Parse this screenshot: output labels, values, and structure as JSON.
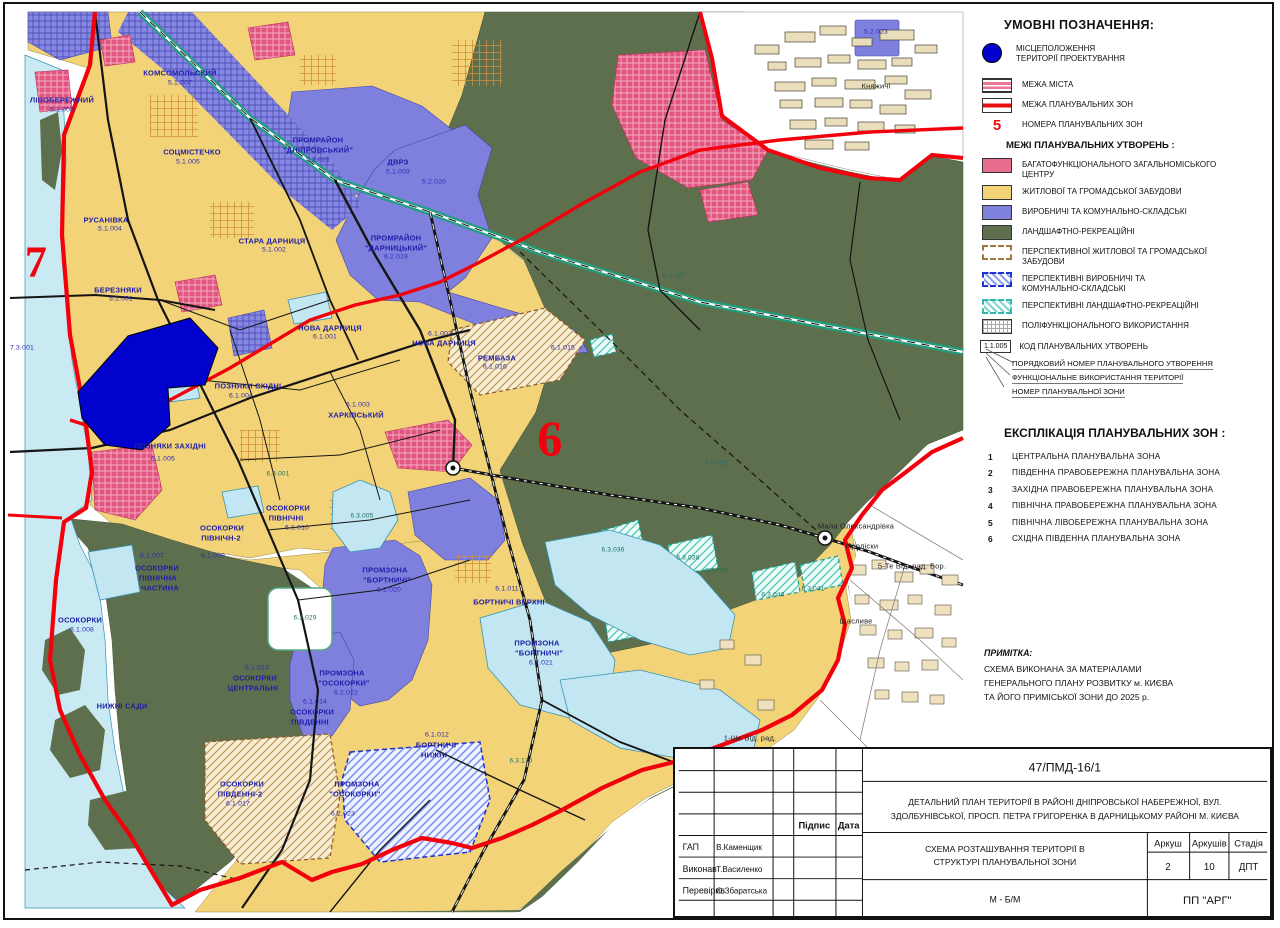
{
  "legend": {
    "title": "УМОВНІ ПОЗНАЧЕННЯ:",
    "location": {
      "lines": [
        "МІСЦЕПОЛОЖЕННЯ",
        "ТЕРИТОРІЇ ПРОЕКТУВАННЯ"
      ]
    },
    "boundary_items": [
      {
        "swatch": "city",
        "label": "МЕЖА МІСТА"
      },
      {
        "swatch": "zone",
        "label": "МЕЖА ПЛАНУВАЛЬНИХ ЗОН"
      },
      {
        "swatch": "number",
        "symbol": "5",
        "label": "НОМЕРА ПЛАНУВАЛЬНИХ ЗОН"
      }
    ]
  },
  "formations": {
    "title": "МЕЖІ ПЛАНУВАЛЬНИХ УТВОРЕНЬ :",
    "items": [
      {
        "swatch": "pink",
        "lines": [
          "БАГАТОФУНКЦІОНАЛЬНОГО ЗАГАЛЬНОМІСЬКОГО",
          "ЦЕНТРУ"
        ]
      },
      {
        "swatch": "yellow",
        "lines": [
          "ЖИТЛОВОЇ ТА ГРОМАДСЬКОЇ ЗАБУДОВИ"
        ]
      },
      {
        "swatch": "purple",
        "lines": [
          "ВИРОБНИЧІ ТА КОМУНАЛЬНО-СКЛАДСЬКІ"
        ]
      },
      {
        "swatch": "green",
        "lines": [
          "ЛАНДШАФТНО-РЕКРЕАЦІЙНІ"
        ]
      },
      {
        "swatch": "dash-tan",
        "lines": [
          "ПЕРСПЕКТИВНОЇ ЖИТЛОВОЇ ТА ГРОМАДСЬКОЇ",
          "ЗАБУДОВИ"
        ]
      },
      {
        "swatch": "dash-blue",
        "lines": [
          "ПЕРСПЕКТИВНІ ВИРОБНИЧІ ТА",
          "КОМУНАЛЬНО-СКЛАДСЬКІ"
        ]
      },
      {
        "swatch": "dash-teal",
        "lines": [
          "ПЕРСПЕКТИВНІ ЛАНДШАФТНО-РЕКРЕАЦІЙНІ"
        ]
      },
      {
        "swatch": "grid",
        "lines": [
          "ПОЛІФУНКЦІОНАЛЬНОГО ВИКОРИСТАННЯ"
        ]
      }
    ],
    "code_example": "1.1.005",
    "code_label": "КОД ПЛАНУВАЛЬНИХ УТВОРЕНЬ",
    "code_callouts": [
      "ПОРЯДКОВИЙ НОМЕР ПЛАНУВАЛЬНОГО УТВОРЕННЯ",
      "ФУНКЦІОНАЛЬНЕ ВИКОРИСТАННЯ ТЕРИТОРІЇ",
      "НОМЕР ПЛАНУВАЛЬНОЇ ЗОНИ"
    ]
  },
  "explication": {
    "title": "ЕКСПЛІКАЦІЯ ПЛАНУВАЛЬНИХ ЗОН :",
    "zones": [
      {
        "num": "1",
        "label": "ЦЕНТРАЛЬНА ПЛАНУВАЛЬНА ЗОНА"
      },
      {
        "num": "2",
        "label": "ПІВДЕННА ПРАВОБЕРЕЖНА  ПЛАНУВАЛЬНА ЗОНА"
      },
      {
        "num": "3",
        "label": "ЗАХІДНА ПРАВОБЕРЕЖНА ПЛАНУВАЛЬНА  ЗОНА"
      },
      {
        "num": "4",
        "label": "ПІВНІЧНА ПРАВОБЕРЕЖНА ПЛАНУВАЛЬНА  ЗОНА"
      },
      {
        "num": "5",
        "label": "ПІВНІЧНА ЛІВОБЕРЕЖНА  ПЛАНУВАЛЬНА ЗОНА"
      },
      {
        "num": "6",
        "label": "СХІДНА ПІВДЕННА ПЛАНУВАЛЬНА ЗОНА"
      }
    ]
  },
  "note": {
    "title": "ПРИМІТКА:",
    "lines": [
      "СХЕМА ВИКОНАНА ЗА МАТЕРІАЛАМИ",
      "ГЕНЕРАЛЬНОГО ПЛАНУ РОЗВИТКУ м. КИЄВА",
      "ТА ЙОГО ПРИМІСЬКОЇ ЗОНИ ДО 2025 р."
    ]
  },
  "stamp": {
    "doc_number": "47/ПМД-16/1",
    "project_title_l1": "ДЕТАЛЬНИЙ  ПЛАН  ТЕРИТОРІЇ  В  РАЙОНІ  ДНІПРОВСЬКОЇ  НАБЕРЕЖНОЇ,  ВУЛ.",
    "project_title_l2": "ЗДОЛБУНІВСЬКОЇ, ПРОСП. ПЕТРА ГРИГОРЕНКА В ДАРНИЦЬКОМУ РАЙОНІ М. КИЄВА",
    "sheet_title_l1": "СХЕМА РОЗТАШУВАННЯ ТЕРИТОРІЇ В",
    "sheet_title_l2": "СТРУКТУРІ ПЛАНУВАЛЬНОЇ ЗОНИ",
    "col_signature": "Підпис",
    "col_date": "Дата",
    "people": [
      {
        "role": "ГАП",
        "name": "В.Каменщик"
      },
      {
        "role": "Виконав",
        "name": "Т.Василенко"
      },
      {
        "role": "Перевірив",
        "name": "О.Збаратська"
      }
    ],
    "sheet_label": "Аркуш",
    "sheets_label": "Аркушів",
    "stage_label": "Стадія",
    "sheet_value": "2",
    "sheets_value": "10",
    "stage_value": "ДПТ",
    "scale": "М - Б/М",
    "company": "ПП \"АРГ\""
  },
  "map": {
    "palette": {
      "residential": "#F2D377",
      "industrial": "#7F80DD",
      "landscape": "#5E6F4D",
      "city_center": "#E2557E",
      "water": "#C9E9F3",
      "project_site": "#0202CF",
      "boundary_red": "#F2000C"
    },
    "labels": [
      {
        "t": "ЛІВОБЕРЕЖНИЙ",
        "x": 62,
        "y": 100,
        "c": "d"
      },
      {
        "t": "5.1.008",
        "x": 62,
        "y": 110,
        "c": "c"
      },
      {
        "t": "КОМСОМОЛЬСКИЙ",
        "x": 180,
        "y": 73,
        "c": "d"
      },
      {
        "t": "5.1.007",
        "x": 180,
        "y": 83,
        "c": "c"
      },
      {
        "t": "СОЦМІСТЕЧКО",
        "x": 192,
        "y": 152,
        "c": "d"
      },
      {
        "t": "5.1.005",
        "x": 188,
        "y": 162,
        "c": "c"
      },
      {
        "t": "РУСАНІВКА",
        "x": 106,
        "y": 220,
        "c": "d"
      },
      {
        "t": "5.1.004",
        "x": 110,
        "y": 229,
        "c": "c"
      },
      {
        "t": "СТАРА ДАРНИЦЯ",
        "x": 272,
        "y": 241,
        "c": "d"
      },
      {
        "t": "5.1.002",
        "x": 274,
        "y": 250,
        "c": "c"
      },
      {
        "t": "БЕРЕЗНЯКИ",
        "x": 118,
        "y": 290,
        "c": "d"
      },
      {
        "t": "5.1.001",
        "x": 121,
        "y": 299,
        "c": "c"
      },
      {
        "t": "ПРОМРАЙОН",
        "x": 318,
        "y": 140,
        "c": "d"
      },
      {
        "t": "\"ДНІПРОВСЬКИЙ\"",
        "x": 318,
        "y": 150,
        "c": "d"
      },
      {
        "t": "5.2.021",
        "x": 318,
        "y": 160,
        "c": "c"
      },
      {
        "t": "ДВРЗ",
        "x": 398,
        "y": 162,
        "c": "d"
      },
      {
        "t": "5.1.003",
        "x": 398,
        "y": 172,
        "c": "c"
      },
      {
        "t": "5.2.020",
        "x": 434,
        "y": 182,
        "c": "c"
      },
      {
        "t": "ПРОМРАЙОН",
        "x": 396,
        "y": 238,
        "c": "d"
      },
      {
        "t": "\"ДАРНИЦЬКИЙ\"",
        "x": 396,
        "y": 248,
        "c": "d"
      },
      {
        "t": "6.2.019",
        "x": 396,
        "y": 257,
        "c": "c"
      },
      {
        "t": "НОВА ДАРНИЦЯ",
        "x": 330,
        "y": 328,
        "c": "d"
      },
      {
        "t": "6.1.001",
        "x": 325,
        "y": 337,
        "c": "c"
      },
      {
        "t": "6.1.002",
        "x": 440,
        "y": 334,
        "c": "c"
      },
      {
        "t": "НОВА ДАРНИЦЯ",
        "x": 444,
        "y": 343,
        "c": "d"
      },
      {
        "t": "РЕМБАЗА",
        "x": 497,
        "y": 358,
        "c": "d"
      },
      {
        "t": "6.1.016",
        "x": 495,
        "y": 367,
        "c": "c"
      },
      {
        "t": "6.1.015",
        "x": 563,
        "y": 348,
        "c": "c"
      },
      {
        "t": "6.1.003",
        "x": 358,
        "y": 405,
        "c": "c"
      },
      {
        "t": "ХАРКІВСЬКИЙ",
        "x": 356,
        "y": 415,
        "c": "d"
      },
      {
        "t": "ПОЗНЯКИ СХІДНІ",
        "x": 248,
        "y": 386,
        "c": "d"
      },
      {
        "t": "6.1.004",
        "x": 241,
        "y": 396,
        "c": "c"
      },
      {
        "t": "ПОЗНЯКИ ЗАХІДНІ",
        "x": 170,
        "y": 446,
        "c": "d"
      },
      {
        "t": "6.1.005",
        "x": 163,
        "y": 459,
        "c": "c"
      },
      {
        "t": "6.3.005",
        "x": 362,
        "y": 516,
        "c": "t"
      },
      {
        "t": "6.3.001",
        "x": 278,
        "y": 474,
        "c": "t"
      },
      {
        "t": "ОСОКОРКИ",
        "x": 288,
        "y": 508,
        "c": "d"
      },
      {
        "t": "ПІВНІЧНІ",
        "x": 286,
        "y": 518,
        "c": "d"
      },
      {
        "t": "6.1.010",
        "x": 297,
        "y": 528,
        "c": "c"
      },
      {
        "t": "ОСОКОРКИ",
        "x": 222,
        "y": 528,
        "c": "d"
      },
      {
        "t": "ПІВНІЧН-2",
        "x": 221,
        "y": 538,
        "c": "d"
      },
      {
        "t": "6.1.009",
        "x": 213,
        "y": 556,
        "c": "c"
      },
      {
        "t": "6.1.007",
        "x": 152,
        "y": 556,
        "c": "c"
      },
      {
        "t": "ОСОКОРКИ",
        "x": 157,
        "y": 568,
        "c": "d"
      },
      {
        "t": "ПІВНІЧНА",
        "x": 158,
        "y": 578,
        "c": "d"
      },
      {
        "t": "ЧАСТИНА",
        "x": 160,
        "y": 588,
        "c": "d"
      },
      {
        "t": "ОСОКОРКИ",
        "x": 80,
        "y": 620,
        "c": "d"
      },
      {
        "t": "6.1.008",
        "x": 82,
        "y": 630,
        "c": "c"
      },
      {
        "t": "НИЖНІ САДИ",
        "x": 122,
        "y": 706,
        "c": "d"
      },
      {
        "t": "6.3.029",
        "x": 305,
        "y": 618,
        "c": "t"
      },
      {
        "t": "6.1.013",
        "x": 257,
        "y": 668,
        "c": "c"
      },
      {
        "t": "ОСОКОРКИ",
        "x": 255,
        "y": 678,
        "c": "d"
      },
      {
        "t": "ЦЕНТРАЛЬНІ",
        "x": 253,
        "y": 688,
        "c": "d"
      },
      {
        "t": "6.1.014",
        "x": 315,
        "y": 702,
        "c": "c"
      },
      {
        "t": "ОСОКОРКИ",
        "x": 312,
        "y": 712,
        "c": "d"
      },
      {
        "t": "ПІВДЕННІ",
        "x": 310,
        "y": 722,
        "c": "d"
      },
      {
        "t": "ПРОМЗОНА",
        "x": 342,
        "y": 673,
        "c": "d"
      },
      {
        "t": "\"ОСОКОРКИ\"",
        "x": 344,
        "y": 683,
        "c": "d"
      },
      {
        "t": "6.2.022",
        "x": 346,
        "y": 693,
        "c": "c"
      },
      {
        "t": "ПРОМЗОНА",
        "x": 385,
        "y": 570,
        "c": "d"
      },
      {
        "t": "\"БОРТНИЧІ\"",
        "x": 387,
        "y": 580,
        "c": "d"
      },
      {
        "t": "6.2.020",
        "x": 389,
        "y": 590,
        "c": "c"
      },
      {
        "t": "6.1.011",
        "x": 507,
        "y": 589,
        "c": "c"
      },
      {
        "t": "БОРТНИЧІ ВЕРХНІ",
        "x": 509,
        "y": 602,
        "c": "d"
      },
      {
        "t": "ПРОМЗОНА",
        "x": 537,
        "y": 643,
        "c": "d"
      },
      {
        "t": "\"БОРТНИЧІ\"",
        "x": 539,
        "y": 653,
        "c": "d"
      },
      {
        "t": "6.2.021",
        "x": 541,
        "y": 663,
        "c": "c"
      },
      {
        "t": "6.1.012",
        "x": 437,
        "y": 735,
        "c": "c"
      },
      {
        "t": "БОРТНИЧІ",
        "x": 436,
        "y": 745,
        "c": "d"
      },
      {
        "t": "НИЖНІ",
        "x": 434,
        "y": 755,
        "c": "d"
      },
      {
        "t": "6.3.170",
        "x": 521,
        "y": 761,
        "c": "t"
      },
      {
        "t": "ОСОКОРКИ",
        "x": 242,
        "y": 784,
        "c": "d"
      },
      {
        "t": "ПІВДЕННІ-2",
        "x": 240,
        "y": 794,
        "c": "d"
      },
      {
        "t": "6.1.017",
        "x": 238,
        "y": 804,
        "c": "c"
      },
      {
        "t": "ПРОМЗОНА",
        "x": 357,
        "y": 784,
        "c": "d"
      },
      {
        "t": "\"ОСОКОРКИ\"",
        "x": 355,
        "y": 794,
        "c": "d"
      },
      {
        "t": "6.2.023",
        "x": 343,
        "y": 814,
        "c": "c"
      },
      {
        "t": "6.3.027",
        "x": 674,
        "y": 276,
        "c": "t"
      },
      {
        "t": "6.3.028",
        "x": 716,
        "y": 463,
        "c": "t"
      },
      {
        "t": "6.3.036",
        "x": 613,
        "y": 550,
        "c": "t"
      },
      {
        "t": "6.3.038",
        "x": 688,
        "y": 558,
        "c": "t"
      },
      {
        "t": "6.3.039",
        "x": 717,
        "y": 571,
        "c": "t"
      },
      {
        "t": "6.3.040",
        "x": 773,
        "y": 595,
        "c": "t"
      },
      {
        "t": "6.3.041",
        "x": 813,
        "y": 589,
        "c": "t"
      },
      {
        "t": "7.3.001",
        "x": 22,
        "y": 348,
        "c": "c"
      },
      {
        "t": "5.2.023",
        "x": 876,
        "y": 32,
        "c": "c"
      },
      {
        "t": "Княжичі",
        "x": 876,
        "y": 86,
        "c": "k"
      },
      {
        "t": "Мала Олександрівка",
        "x": 856,
        "y": 526,
        "c": "k"
      },
      {
        "t": "Проліски",
        "x": 862,
        "y": 546,
        "c": "k"
      },
      {
        "t": "5-Те Від. рад. Бор.",
        "x": 912,
        "y": 566,
        "c": "k"
      },
      {
        "t": "Щасливе",
        "x": 856,
        "y": 621,
        "c": "k"
      },
      {
        "t": "1-Ше Від. рад.",
        "x": 750,
        "y": 738,
        "c": "k"
      },
      {
        "t": "7",
        "x": 36,
        "y": 262,
        "c": "r",
        "s": 44
      },
      {
        "t": "6",
        "x": 550,
        "y": 438,
        "c": "r",
        "s": 50
      }
    ]
  }
}
